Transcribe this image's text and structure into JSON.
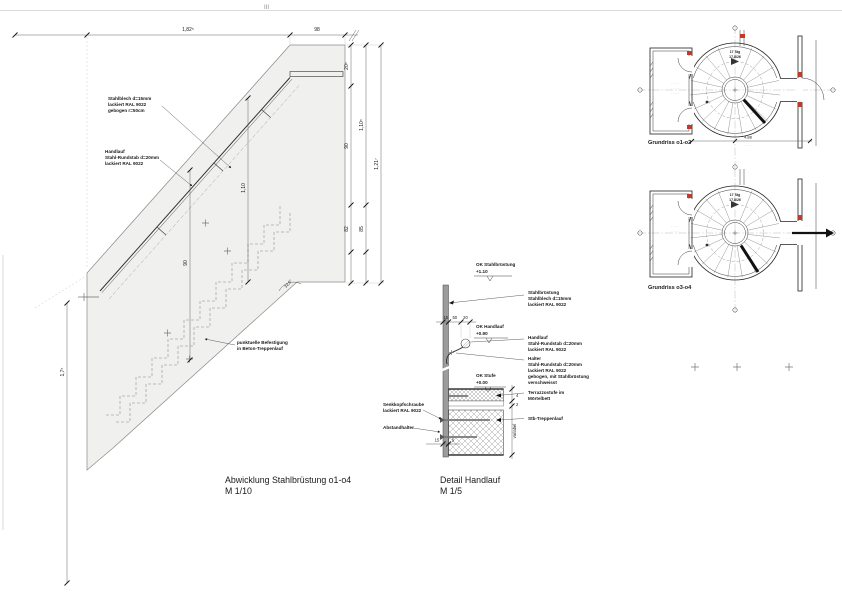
{
  "sheet": {
    "fold_mark": "III"
  },
  "colors": {
    "fill_gray": "#f0f0ee",
    "accent_red": "#c4372b",
    "bar_gray": "#9c9c9c",
    "line": "#333333"
  },
  "elevation": {
    "title": "Abwicklung Stahlbrüstung o1-o4",
    "scale": "M 1/10",
    "notes": {
      "blech": [
        "Stahlblech d=15mm",
        "lackiert RAL 9022",
        "gebogen r=50cm"
      ],
      "handlauf": [
        "Handlauf",
        "Stahl-Rundstab d=20mm",
        "lackiert RAL 9022"
      ],
      "befestigung": [
        "punktuelle Befestigung",
        "in Beton-Treppenlauf"
      ]
    },
    "dims": {
      "top_1": "1,82⁵",
      "top_2": "98",
      "r1": "20⁵",
      "r2": "90",
      "r3": "82",
      "r4": "1,10⁵",
      "r5": "85",
      "r6": "1,21⁷",
      "left": "1,7⁵",
      "inner_1": "1,10",
      "inner_2": "90",
      "angle": "32,5°"
    }
  },
  "detail": {
    "title": "Detail Handlauf",
    "scale": "M 1/5",
    "levels": {
      "bruestung": {
        "label": "OK Stahlbrüstung",
        "value": "+1.10"
      },
      "handlauf": {
        "label": "OK Handlauf",
        "value": "+0.90"
      },
      "stufe": {
        "label": "OK Stufe",
        "value": "+0.00"
      }
    },
    "notes": {
      "bruestung": [
        "Stahlbrüstung",
        "Stahlblech d=15mm",
        "lackiert RAL 9022"
      ],
      "handlauf": [
        "Handlauf",
        "Stahl-Rundstab d=20mm",
        "lackiert RAL 9022"
      ],
      "halter": [
        "Halter",
        "Stahl-Rundstab d=20mm",
        "lackiert RAL 9022",
        "gebogen, mit Stahlbrüstung",
        "verschweisst"
      ],
      "terrazzo": [
        "Terrazzostufe im",
        "Mörtelbett"
      ],
      "stb": "Stb-Treppenlauf",
      "schraube": [
        "Senkkopfschraube",
        "lackiert RAL 9022"
      ],
      "abstandhalter": "Abstandhalter"
    },
    "dims": {
      "t1": "15",
      "t2": "50",
      "t3": "20",
      "b1": "15",
      "b2": "5",
      "r1": "4",
      "r2": "2",
      "variabel": "variabel"
    }
  },
  "plans": {
    "plan1": {
      "caption": "Grundriss o1-o2",
      "steps_1": "17 Stg",
      "steps_2": "17,8/26",
      "dim": "4,88",
      "micro": "· · · · ·"
    },
    "plan2": {
      "caption": "Grundriss o3-o4",
      "steps_1": "17 Stg",
      "steps_2": "17,8/26",
      "micro": "· · · · ·"
    }
  }
}
